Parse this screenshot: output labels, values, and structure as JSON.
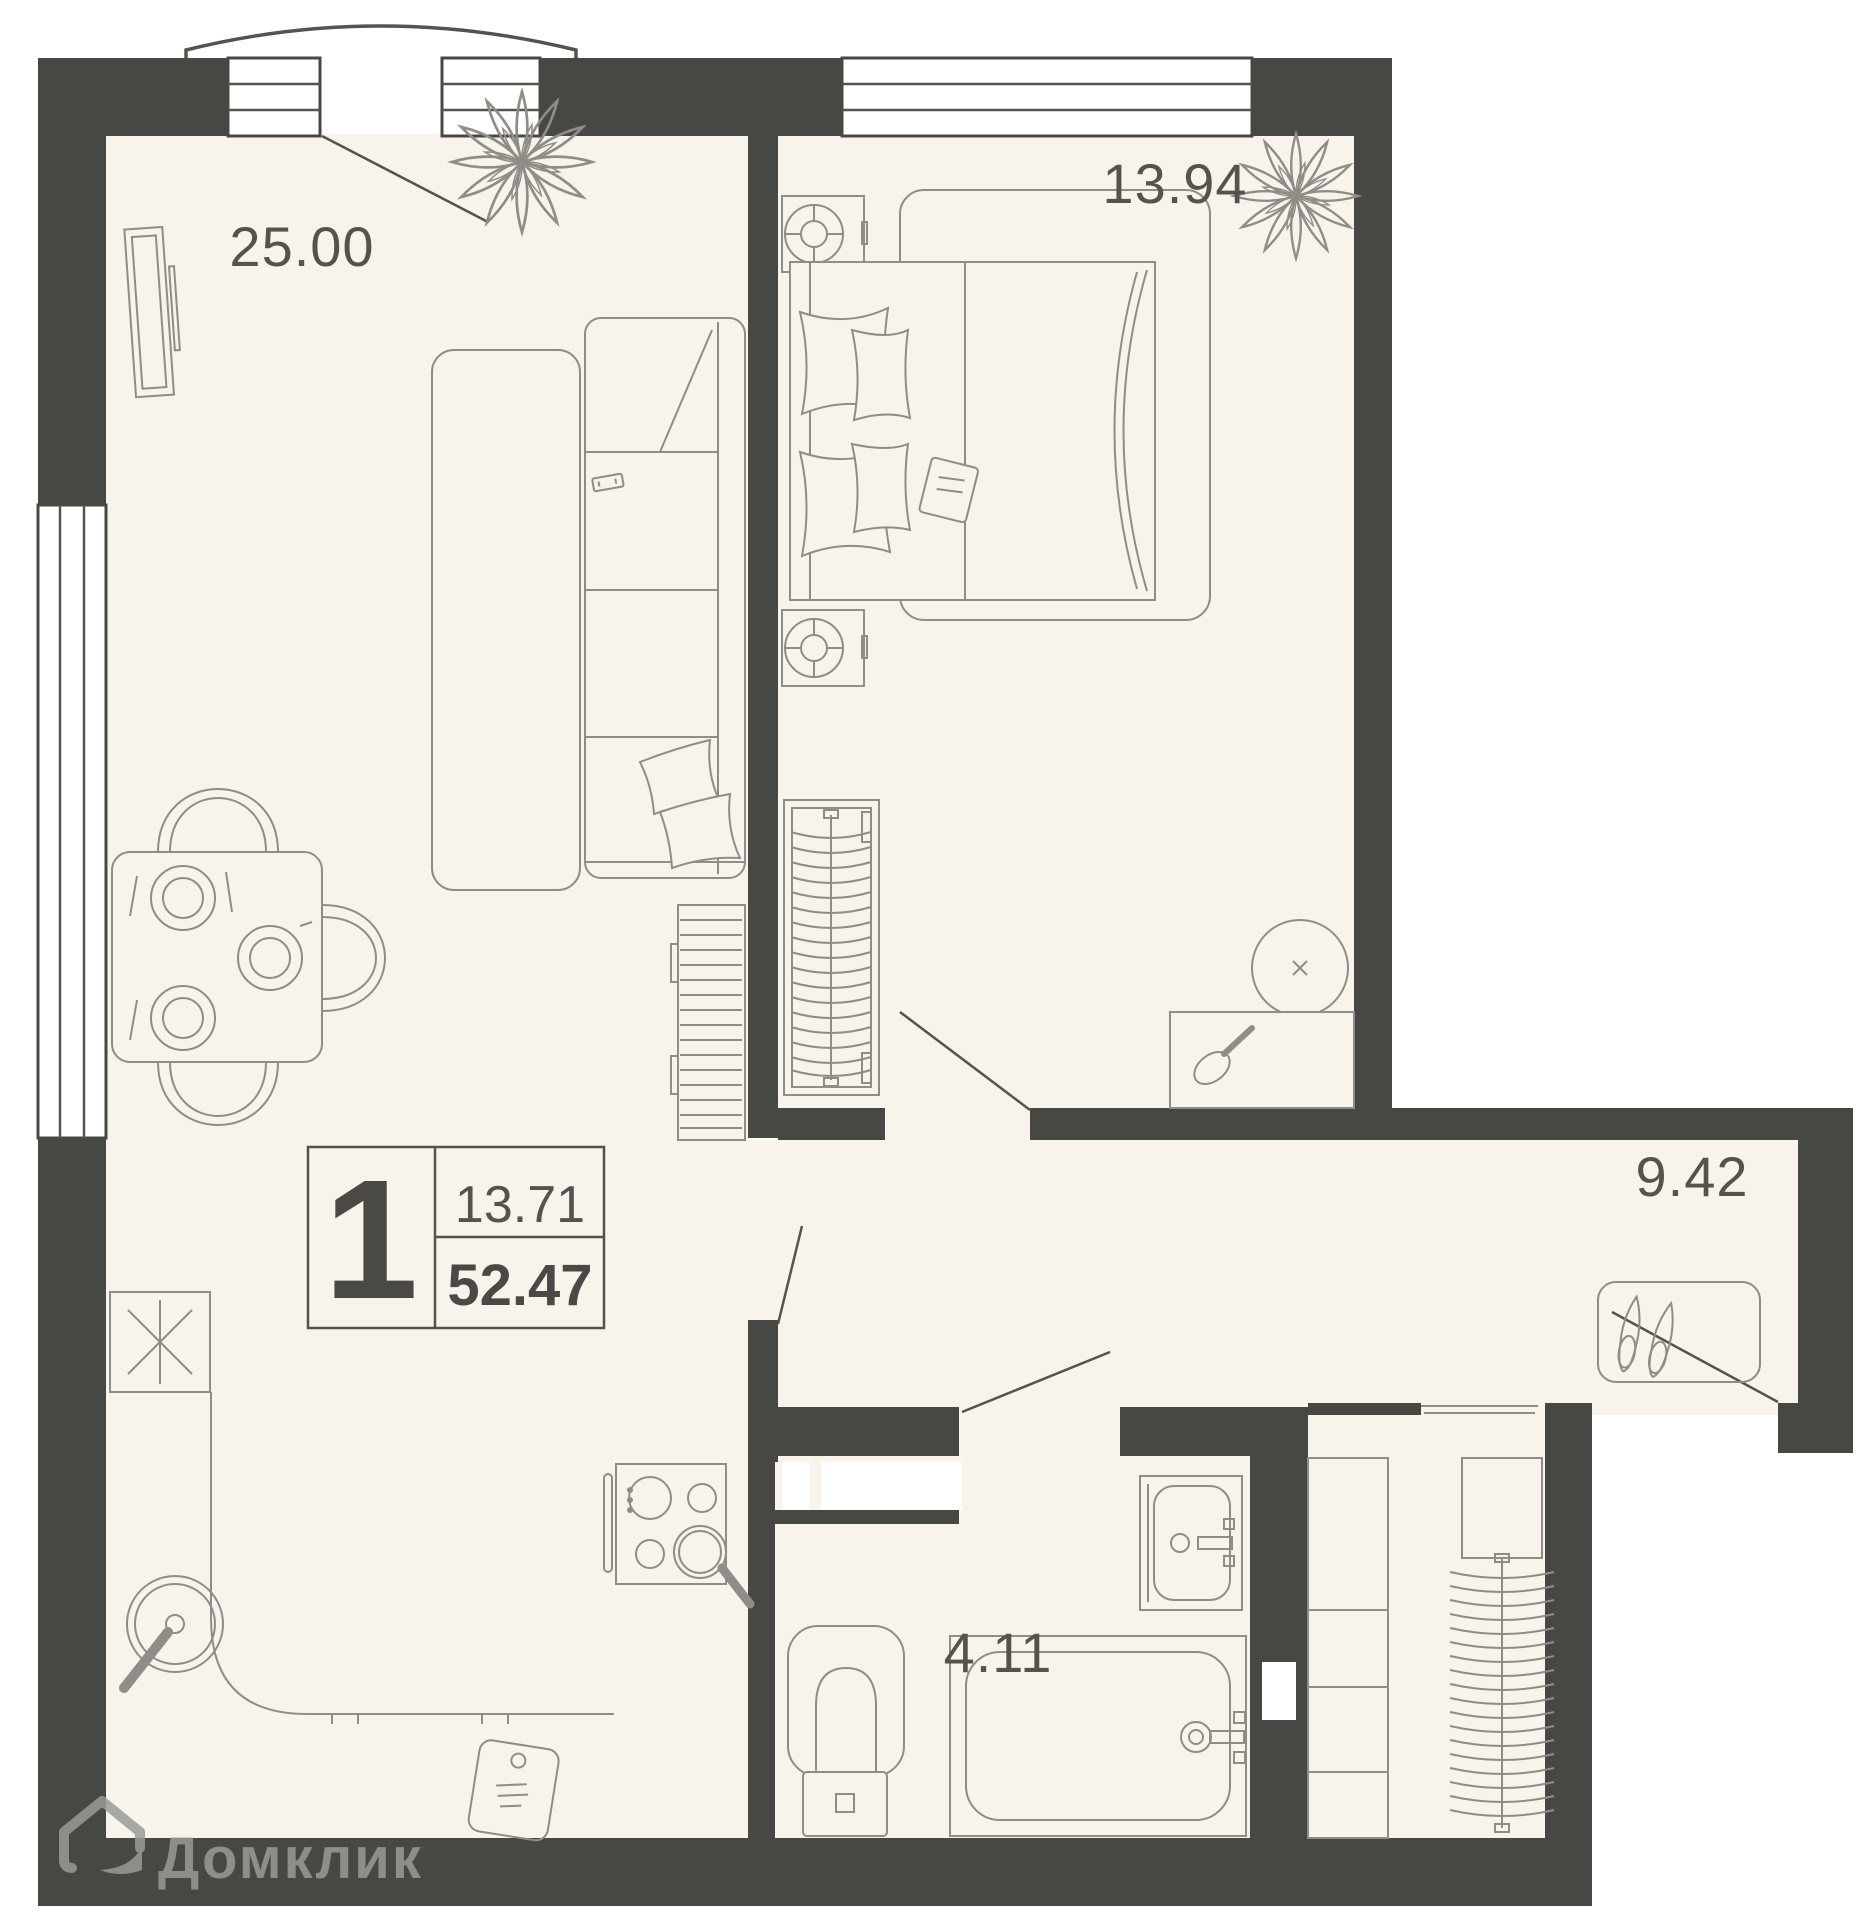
{
  "plan": {
    "badge": {
      "rooms_count": "1",
      "room_area": "13.71",
      "total_area": "52.47"
    },
    "rooms": [
      {
        "id": "living",
        "area_label": "25.00"
      },
      {
        "id": "bedroom",
        "area_label": "13.94"
      },
      {
        "id": "hallway",
        "area_label": "9.42"
      },
      {
        "id": "bathroom",
        "area_label": "4.11"
      }
    ],
    "watermark": {
      "brand": "Домклик"
    },
    "colors": {
      "page": "#ffffff",
      "floor": "#f8f4ec",
      "wall": "#474744",
      "furniture_line": "#8e8d87",
      "text": "#54534d",
      "watermark": "#9a9a97"
    },
    "icons": [
      "house-logo-icon",
      "plant-icon",
      "sofa-icon",
      "bed-icon",
      "pillow-icon",
      "tv-icon",
      "dining-table-icon",
      "chair-icon",
      "plate-icon",
      "wardrobe-icon",
      "hanger-icon",
      "nightstand-icon",
      "lamp-icon",
      "mirror-icon",
      "vanity-icon",
      "hairbrush-icon",
      "shoe-cabinet-icon",
      "shoes-icon",
      "toilet-icon",
      "bathtub-icon",
      "bath-sink-icon",
      "kitchen-sink-icon",
      "cooktop-icon",
      "pan-icon",
      "washer-icon",
      "cutting-board-icon",
      "remote-icon",
      "book-icon",
      "window-icon",
      "door-swing-icon"
    ]
  }
}
